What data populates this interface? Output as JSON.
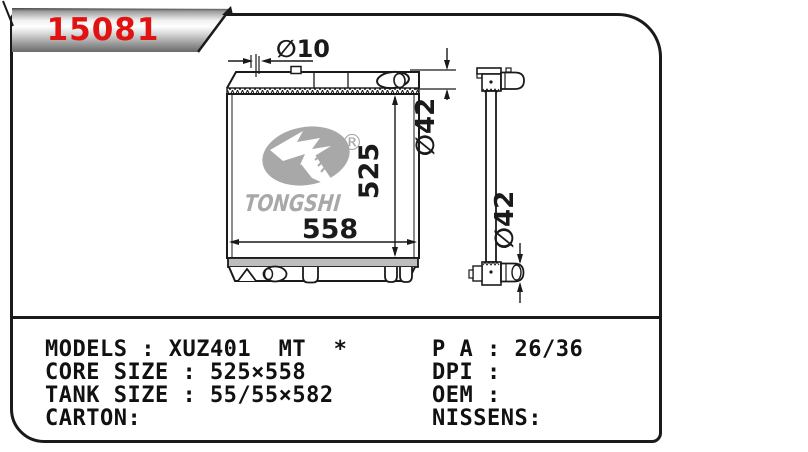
{
  "part_number": "15081",
  "brand": {
    "name": "TONGSHI",
    "registered_mark": "®"
  },
  "dimensions": {
    "filler_neck_diameter": "∅10",
    "top_pipe_diameter": "∅42",
    "core_height": "525",
    "core_width": "558",
    "side_pipe_diameter": "∅42"
  },
  "specs": {
    "left": [
      "MODELS : XUZ401  MT  *",
      "CORE SIZE : 525×558",
      "TANK SIZE : 55/55×582",
      "CARTON:"
    ],
    "right": [
      "P A : 26/36",
      "DPI :",
      "OEM :",
      "NISSENS:"
    ]
  },
  "colors": {
    "accent_red": "#e01212",
    "line_black": "#1a1a1a",
    "logo_gray": "#a8a8a8",
    "flange_gray": "#bdbdbd"
  }
}
